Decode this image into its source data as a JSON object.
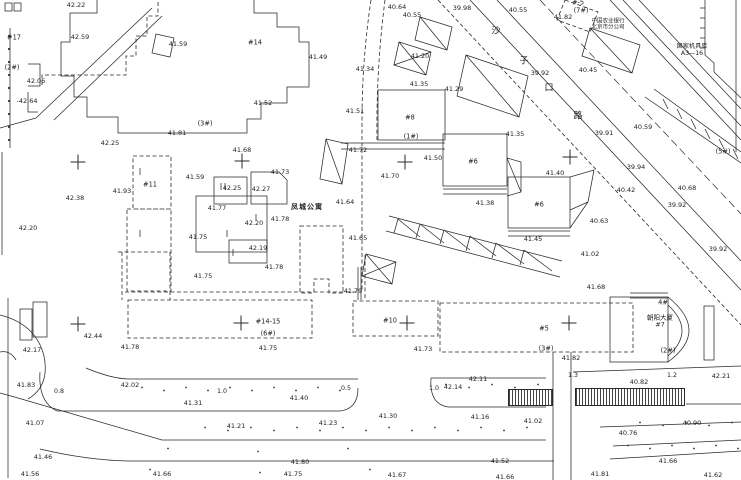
{
  "colors": {
    "paper": "#ffffff",
    "ink": "#222222"
  },
  "texts": {
    "apartment_name": "凤城公寓",
    "tower_name": "朝阳大厦",
    "tower_no": "#7",
    "agency_line1": "中国农业银行",
    "agency_line2": "北京市分公司",
    "depot_line1": "国家机具库",
    "depot_line2": "A3—16"
  },
  "street": {
    "name": "沙子口路",
    "chars": [
      {
        "t": "沙",
        "x": 496,
        "y": 30
      },
      {
        "t": "子",
        "x": 524,
        "y": 60
      },
      {
        "t": "口",
        "x": 549,
        "y": 87
      },
      {
        "t": "路",
        "x": 578,
        "y": 115
      }
    ]
  },
  "elevations": [
    {
      "t": "42.22",
      "x": 76,
      "y": 5
    },
    {
      "t": "42.59",
      "x": 80,
      "y": 37
    },
    {
      "t": "41.59",
      "x": 178,
      "y": 44
    },
    {
      "t": "42.06",
      "x": 36,
      "y": 81
    },
    {
      "t": "-42.64",
      "x": 27,
      "y": 101
    },
    {
      "t": "41.81",
      "x": 177,
      "y": 133
    },
    {
      "t": "42.25",
      "x": 110,
      "y": 143
    },
    {
      "t": "42.38",
      "x": 75,
      "y": 198
    },
    {
      "t": "41.93",
      "x": 122,
      "y": 191
    },
    {
      "t": "42.20",
      "x": 28,
      "y": 228
    },
    {
      "t": "41.59",
      "x": 195,
      "y": 177
    },
    {
      "t": "41.68",
      "x": 242,
      "y": 150
    },
    {
      "t": "41.73",
      "x": 280,
      "y": 172
    },
    {
      "t": "42.25",
      "x": 232,
      "y": 188
    },
    {
      "t": "42.27",
      "x": 261,
      "y": 189
    },
    {
      "t": "41.77",
      "x": 217,
      "y": 208
    },
    {
      "t": "42.20",
      "x": 254,
      "y": 223
    },
    {
      "t": "41.78",
      "x": 280,
      "y": 219
    },
    {
      "t": "41.75",
      "x": 198,
      "y": 237
    },
    {
      "t": "42.19",
      "x": 258,
      "y": 248
    },
    {
      "t": "41.78",
      "x": 274,
      "y": 267
    },
    {
      "t": "41.75",
      "x": 203,
      "y": 276
    },
    {
      "t": "40.64",
      "x": 397,
      "y": 7
    },
    {
      "t": "40.55",
      "x": 412,
      "y": 15
    },
    {
      "t": "39.98",
      "x": 462,
      "y": 8
    },
    {
      "t": "40.55",
      "x": 518,
      "y": 10
    },
    {
      "t": "41.82",
      "x": 563,
      "y": 17
    },
    {
      "t": "41.49",
      "x": 318,
      "y": 57
    },
    {
      "t": "41.52",
      "x": 263,
      "y": 103
    },
    {
      "t": "41.51",
      "x": 355,
      "y": 111
    },
    {
      "t": "41.34",
      "x": 365,
      "y": 69
    },
    {
      "t": "41.20",
      "x": 420,
      "y": 56
    },
    {
      "t": "41.35",
      "x": 419,
      "y": 84
    },
    {
      "t": "41.29",
      "x": 454,
      "y": 89
    },
    {
      "t": "41.72",
      "x": 358,
      "y": 150
    },
    {
      "t": "41.50",
      "x": 433,
      "y": 158
    },
    {
      "t": "41.70",
      "x": 390,
      "y": 176
    },
    {
      "t": "41.64",
      "x": 345,
      "y": 202
    },
    {
      "t": "41.65",
      "x": 358,
      "y": 238
    },
    {
      "t": "41.79",
      "x": 353,
      "y": 291
    },
    {
      "t": "41.38",
      "x": 485,
      "y": 203
    },
    {
      "t": "41.35",
      "x": 515,
      "y": 134
    },
    {
      "t": "41.40",
      "x": 555,
      "y": 173
    },
    {
      "t": "41.45",
      "x": 533,
      "y": 239
    },
    {
      "t": "40.45",
      "x": 588,
      "y": 70
    },
    {
      "t": "39.92",
      "x": 540,
      "y": 73
    },
    {
      "t": "39.91",
      "x": 604,
      "y": 133
    },
    {
      "t": "40.59",
      "x": 643,
      "y": 127
    },
    {
      "t": "39.94",
      "x": 636,
      "y": 167
    },
    {
      "t": "40.42",
      "x": 626,
      "y": 190
    },
    {
      "t": "39.92",
      "x": 677,
      "y": 205
    },
    {
      "t": "40.68",
      "x": 687,
      "y": 188
    },
    {
      "t": "40.63",
      "x": 599,
      "y": 221
    },
    {
      "t": "39.92",
      "x": 718,
      "y": 249
    },
    {
      "t": "41.02",
      "x": 590,
      "y": 254
    },
    {
      "t": "41.68",
      "x": 596,
      "y": 287
    },
    {
      "t": "41.82",
      "x": 571,
      "y": 358
    },
    {
      "t": "41.75",
      "x": 268,
      "y": 348
    },
    {
      "t": "41.73",
      "x": 423,
      "y": 349
    },
    {
      "t": "42.44",
      "x": 93,
      "y": 336
    },
    {
      "t": "42.17",
      "x": 32,
      "y": 350
    },
    {
      "t": "41.78",
      "x": 130,
      "y": 347
    },
    {
      "t": "41.83",
      "x": 26,
      "y": 385
    },
    {
      "t": "42.02",
      "x": 130,
      "y": 385
    },
    {
      "t": "41.31",
      "x": 193,
      "y": 403
    },
    {
      "t": "41.40",
      "x": 299,
      "y": 398
    },
    {
      "t": "42.14",
      "x": 453,
      "y": 387
    },
    {
      "t": "42.11",
      "x": 478,
      "y": 379
    },
    {
      "t": "40.82",
      "x": 639,
      "y": 382
    },
    {
      "t": "42.21",
      "x": 721,
      "y": 376
    },
    {
      "t": "41.07",
      "x": 35,
      "y": 423
    },
    {
      "t": "41.21",
      "x": 236,
      "y": 426
    },
    {
      "t": "41.23",
      "x": 328,
      "y": 423
    },
    {
      "t": "41.30",
      "x": 388,
      "y": 416
    },
    {
      "t": "41.16",
      "x": 480,
      "y": 417
    },
    {
      "t": "41.02",
      "x": 533,
      "y": 421
    },
    {
      "t": "40.76",
      "x": 628,
      "y": 433
    },
    {
      "t": "40.90",
      "x": 692,
      "y": 423
    },
    {
      "t": "41.46",
      "x": 43,
      "y": 457
    },
    {
      "t": "41.80",
      "x": 300,
      "y": 462
    },
    {
      "t": "41.52",
      "x": 500,
      "y": 461
    },
    {
      "t": "41.66",
      "x": 668,
      "y": 461
    },
    {
      "t": "41.56",
      "x": 30,
      "y": 474
    },
    {
      "t": "41.66",
      "x": 162,
      "y": 474
    },
    {
      "t": "41.75",
      "x": 293,
      "y": 474
    },
    {
      "t": "41.67",
      "x": 397,
      "y": 475
    },
    {
      "t": "41.66",
      "x": 505,
      "y": 477
    },
    {
      "t": "41.81",
      "x": 600,
      "y": 474
    },
    {
      "t": "41.62",
      "x": 713,
      "y": 475
    }
  ],
  "building_labels": [
    {
      "t": "#17",
      "x": 14,
      "y": 38
    },
    {
      "t": "(2#)",
      "x": 12,
      "y": 68
    },
    {
      "t": "#14",
      "x": 255,
      "y": 43
    },
    {
      "t": "(3#)",
      "x": 205,
      "y": 124
    },
    {
      "t": "#11",
      "x": 150,
      "y": 185
    },
    {
      "t": "#8",
      "x": 410,
      "y": 118
    },
    {
      "t": "(1#)",
      "x": 411,
      "y": 137
    },
    {
      "t": "#6",
      "x": 473,
      "y": 162
    },
    {
      "t": "#6",
      "x": 539,
      "y": 205
    },
    {
      "t": "(5#)",
      "x": 723,
      "y": 152
    },
    {
      "t": "#-5",
      "x": 578,
      "y": 3
    },
    {
      "t": "(7#)",
      "x": 581,
      "y": 11
    },
    {
      "t": "#14-15",
      "x": 268,
      "y": 322
    },
    {
      "t": "(6#)",
      "x": 268,
      "y": 334
    },
    {
      "t": "#10",
      "x": 390,
      "y": 321
    },
    {
      "t": "#5",
      "x": 544,
      "y": 329
    },
    {
      "t": "(3#)",
      "x": 546,
      "y": 349
    },
    {
      "t": "4#",
      "x": 663,
      "y": 303
    },
    {
      "t": "(2#)",
      "x": 668,
      "y": 351
    }
  ],
  "distances": [
    {
      "t": "0.8",
      "x": 59,
      "y": 392
    },
    {
      "t": "1.0",
      "x": 222,
      "y": 392
    },
    {
      "t": "0.5",
      "x": 346,
      "y": 389
    },
    {
      "t": "1.0",
      "x": 434,
      "y": 389
    },
    {
      "t": "1.3",
      "x": 573,
      "y": 376
    },
    {
      "t": "1.2",
      "x": 672,
      "y": 376
    }
  ],
  "grid_crosses": [
    {
      "x": 78,
      "y": 162
    },
    {
      "x": 242,
      "y": 161
    },
    {
      "x": 405,
      "y": 162
    },
    {
      "x": 570,
      "y": 157
    },
    {
      "x": 78,
      "y": 324
    },
    {
      "x": 241,
      "y": 323
    },
    {
      "x": 407,
      "y": 323
    },
    {
      "x": 569,
      "y": 323
    }
  ]
}
